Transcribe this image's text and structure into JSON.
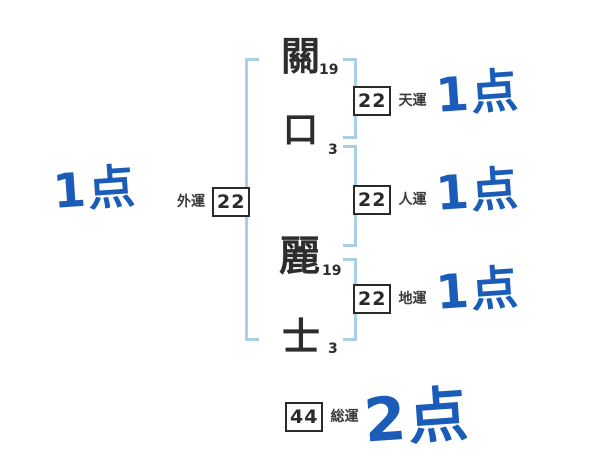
{
  "title": "姓名判断の画数診断図",
  "name_chars": [
    {
      "char": "關",
      "strokes": "19"
    },
    {
      "char": "口",
      "strokes": "3"
    },
    {
      "char": "麗",
      "strokes": "19"
    },
    {
      "char": "士",
      "strokes": "3"
    }
  ],
  "fortunes": {
    "heaven": {
      "label": "天運",
      "value": "22",
      "score": "1点"
    },
    "person": {
      "label": "人運",
      "value": "22",
      "score": "1点"
    },
    "earth": {
      "label": "地運",
      "value": "22",
      "score": "1点"
    },
    "outer": {
      "label": "外運",
      "value": "22",
      "score": "1点"
    },
    "total": {
      "label": "総運",
      "value": "44",
      "score": "2点"
    }
  },
  "colors": {
    "score_blue": "#1a5cb8",
    "bracket_blue": "#a9cfe8",
    "ink": "#2d2d2d"
  }
}
